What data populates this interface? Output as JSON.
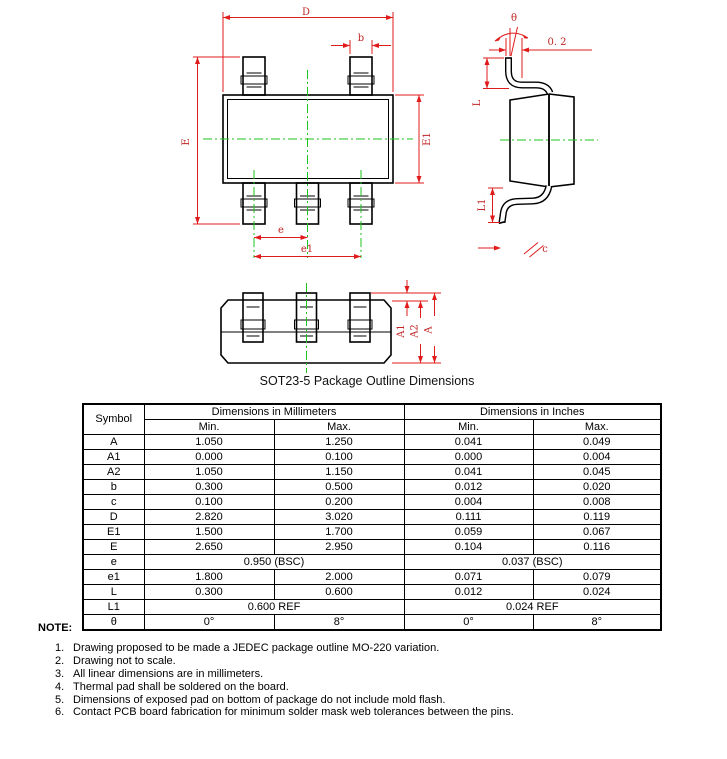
{
  "drawing": {
    "caption": "SOT23-5 Package Outline Dimensions",
    "labels": {
      "D": "D",
      "b": "b",
      "E": "E",
      "E1": "E1",
      "e": "e",
      "e1": "e1",
      "theta": "θ",
      "offset": "0. 2",
      "L": "L",
      "L1": "L1",
      "c": "c",
      "A": "A",
      "A1": "A1",
      "A2": "A2"
    }
  },
  "table": {
    "headers": {
      "symbol": "Symbol",
      "mm": "Dimensions in Millimeters",
      "inch": "Dimensions in Inches",
      "min": "Min.",
      "max": "Max."
    },
    "rows": [
      {
        "symbol": "A",
        "mm_min": "1.050",
        "mm_max": "1.250",
        "in_min": "0.041",
        "in_max": "0.049"
      },
      {
        "symbol": "A1",
        "mm_min": "0.000",
        "mm_max": "0.100",
        "in_min": "0.000",
        "in_max": "0.004"
      },
      {
        "symbol": "A2",
        "mm_min": "1.050",
        "mm_max": "1.150",
        "in_min": "0.041",
        "in_max": "0.045"
      },
      {
        "symbol": "b",
        "mm_min": "0.300",
        "mm_max": "0.500",
        "in_min": "0.012",
        "in_max": "0.020"
      },
      {
        "symbol": "c",
        "mm_min": "0.100",
        "mm_max": "0.200",
        "in_min": "0.004",
        "in_max": "0.008"
      },
      {
        "symbol": "D",
        "mm_min": "2.820",
        "mm_max": "3.020",
        "in_min": "0.111",
        "in_max": "0.119"
      },
      {
        "symbol": "E1",
        "mm_min": "1.500",
        "mm_max": "1.700",
        "in_min": "0.059",
        "in_max": "0.067"
      },
      {
        "symbol": "E",
        "mm_min": "2.650",
        "mm_max": "2.950",
        "in_min": "0.104",
        "in_max": "0.116"
      },
      {
        "symbol": "e",
        "mm_span": "0.950 (BSC)",
        "in_span": "0.037 (BSC)"
      },
      {
        "symbol": "e1",
        "mm_min": "1.800",
        "mm_max": "2.000",
        "in_min": "0.071",
        "in_max": "0.079"
      },
      {
        "symbol": "L",
        "mm_min": "0.300",
        "mm_max": "0.600",
        "in_min": "0.012",
        "in_max": "0.024"
      },
      {
        "symbol": "L1",
        "mm_span": "0.600 REF",
        "in_span": "0.024 REF"
      },
      {
        "symbol": "θ",
        "mm_min": "0°",
        "mm_max": "8°",
        "in_min": "0°",
        "in_max": "8°"
      }
    ]
  },
  "notes": {
    "title": "NOTE:",
    "items": [
      {
        "num": "1.",
        "text": "Drawing proposed to be made a JEDEC package outline MO-220 variation."
      },
      {
        "num": "2.",
        "text": "Drawing not to scale."
      },
      {
        "num": "3.",
        "text": "All linear dimensions are in millimeters."
      },
      {
        "num": "4.",
        "text": "Thermal pad shall be soldered on the board."
      },
      {
        "num": "5.",
        "text": "Dimensions of exposed pad on bottom of package do not include mold flash."
      },
      {
        "num": "6.",
        "text": "Contact PCB board fabrication for minimum solder mask web tolerances between the pins."
      }
    ]
  }
}
